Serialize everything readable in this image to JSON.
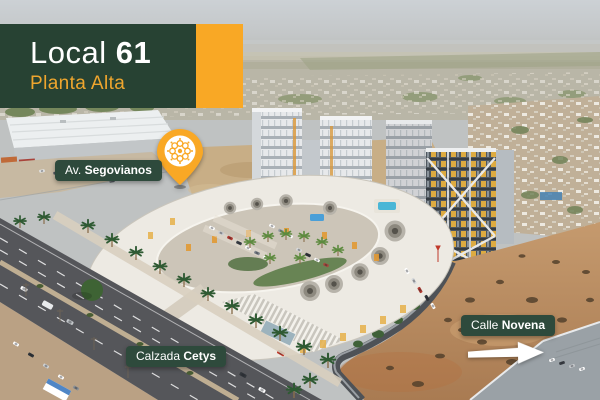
{
  "badge": {
    "unit_label": "Local",
    "unit_number": "61",
    "floor": "Planta Alta"
  },
  "pin_label": {
    "prefix": "Av.",
    "name": "Segovianos"
  },
  "street_labels": {
    "bottom": {
      "prefix": "Calzada",
      "name": "Cetys"
    },
    "right": {
      "prefix": "Calle",
      "name": "Novena"
    }
  },
  "icons": {
    "location_pin": "map-pin-icon",
    "pin_emblem": "flower-logo-icon",
    "direction_arrow": "arrow-right-icon"
  },
  "colors": {
    "badge_green": "#274233",
    "label_green": "#2e4a3c",
    "accent_orange": "#f9a825",
    "subtitle_orange": "#efa62e",
    "text_white": "#ffffff"
  }
}
